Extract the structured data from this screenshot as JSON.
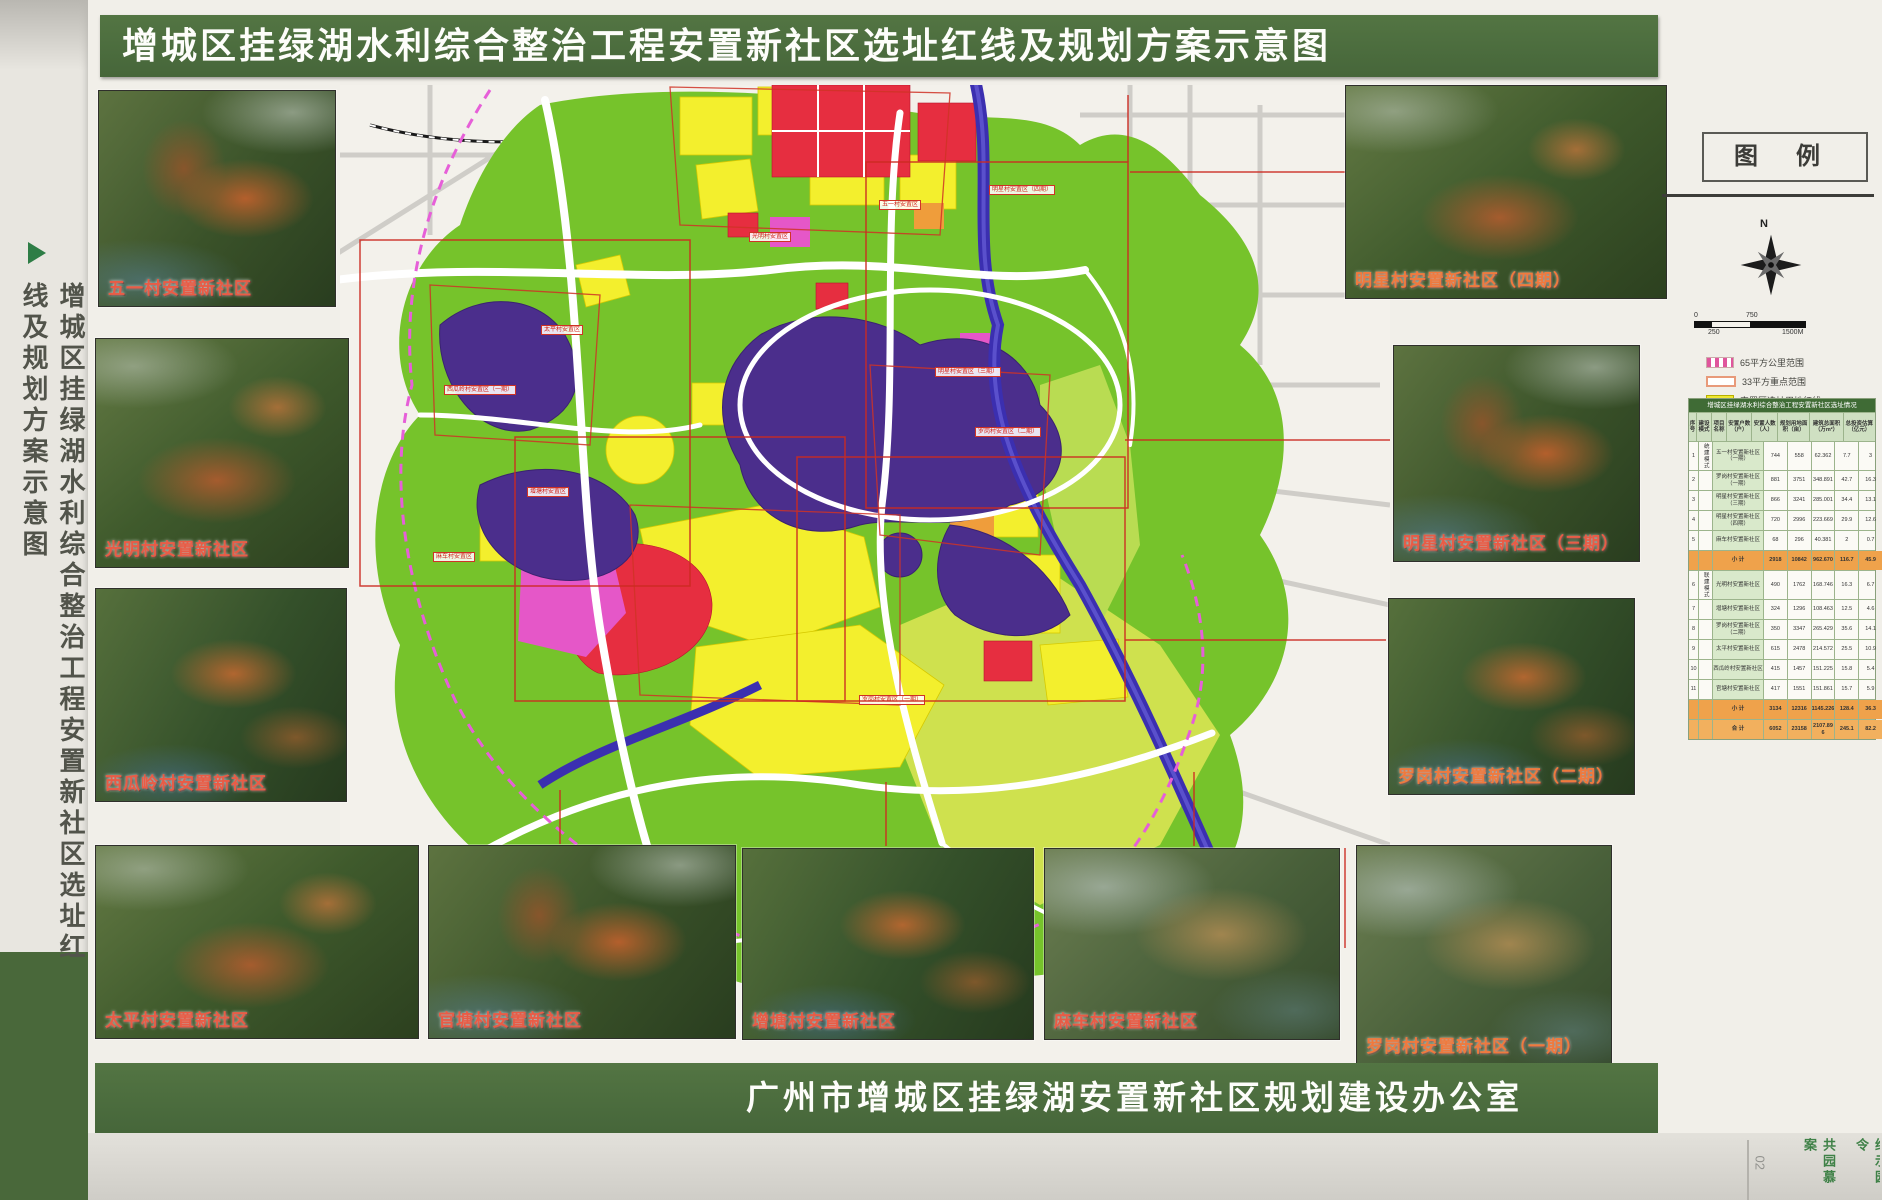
{
  "title_banner": "增城区挂绿湖水利综合整治工程安置新社区选址红线及规划方案示意图",
  "side_title": "增城区挂绿湖水利综合整治工程安置新社区选址红线及规划方案示意图",
  "footer_banner": "广州市增城区挂绿湖安置新社区规划建设办公室",
  "page_number": "02",
  "edge_texts": [
    "共园慕案",
    "给示园令"
  ],
  "photos": {
    "wuyi": {
      "label": "五一村安置新社区"
    },
    "guangming": {
      "label": "光明村安置新社区"
    },
    "xigualing": {
      "label": "西瓜岭村安置新社区"
    },
    "taiping": {
      "label": "太平村安置新社区"
    },
    "guantang": {
      "label": "官塘村安置新社区"
    },
    "zengtang": {
      "label": "增塘村安置新社区"
    },
    "mache": {
      "label": "麻车村安置新社区"
    },
    "luogang1": {
      "label": "罗岗村安置新社区（一期）"
    },
    "mingxing4": {
      "label": "明星村安置新社区（四期）"
    },
    "mingxing3": {
      "label": "明星村安置新社区（三期）"
    },
    "luogang2": {
      "label": "罗岗村安置新社区（二期）"
    }
  },
  "legend": {
    "title": "图 例",
    "compass_label": "N",
    "scale": {
      "t0": "0",
      "t750": "750",
      "t250": "250",
      "t1500": "1500M"
    },
    "items": [
      {
        "label": "65平方公里范围",
        "type": "dashed"
      },
      {
        "label": "33平方重点范围",
        "type": "outline"
      },
      {
        "label": "安置区选址用地红线",
        "type": "yellow"
      },
      {
        "label": "水面",
        "type": "water"
      }
    ],
    "table": {
      "title": "增城区挂绿湖水利综合整治工程安置新社区选址情况",
      "headers": [
        {
          "t": "序号"
        },
        {
          "t": "建设模式"
        },
        {
          "t": "项目名称"
        },
        {
          "t": "安置户数（户）"
        },
        {
          "t": "安置人数（人）"
        },
        {
          "t": "规划用地面积（亩）"
        },
        {
          "t": "建筑总面积（万m²）"
        },
        {
          "t": "总投资估算（亿元）"
        }
      ],
      "rows": [
        {
          "no": "1",
          "mode": "统建模式",
          "name": "五一村安置新社区（一期）",
          "hh": "744",
          "pp": "558",
          "area": "62.362",
          "floor": "7.7",
          "inv": "3",
          "cls": ""
        },
        {
          "no": "2",
          "mode": "",
          "name": "罗岗村安置新社区（一期）",
          "hh": "881",
          "pp": "3751",
          "area": "348.891",
          "floor": "42.7",
          "inv": "16.3",
          "cls": ""
        },
        {
          "no": "3",
          "mode": "",
          "name": "明星村安置新社区（三期）",
          "hh": "866",
          "pp": "3241",
          "area": "285.001",
          "floor": "34.4",
          "inv": "13.1",
          "cls": ""
        },
        {
          "no": "4",
          "mode": "",
          "name": "明星村安置新社区（四期）",
          "hh": "720",
          "pp": "2996",
          "area": "223.669",
          "floor": "29.9",
          "inv": "12.6",
          "cls": ""
        },
        {
          "no": "5",
          "mode": "",
          "name": "麻车村安置新社区",
          "hh": "68",
          "pp": "296",
          "area": "40.381",
          "floor": "2",
          "inv": "0.7",
          "cls": ""
        },
        {
          "no": "",
          "mode": "",
          "name": "小 计",
          "hh": "2918",
          "pp": "10842",
          "area": "962.670",
          "floor": "116.7",
          "inv": "45.9",
          "cls": "sum"
        },
        {
          "no": "6",
          "mode": "联建模式",
          "name": "光明村安置新社区",
          "hh": "490",
          "pp": "1762",
          "area": "168.746",
          "floor": "16.3",
          "inv": "6.7",
          "cls": ""
        },
        {
          "no": "7",
          "mode": "",
          "name": "增塘村安置新社区",
          "hh": "324",
          "pp": "1296",
          "area": "108.463",
          "floor": "12.5",
          "inv": "4.6",
          "cls": ""
        },
        {
          "no": "8",
          "mode": "",
          "name": "罗岗村安置新社区（二期）",
          "hh": "350",
          "pp": "3347",
          "area": "265.429",
          "floor": "35.6",
          "inv": "14.1",
          "cls": ""
        },
        {
          "no": "9",
          "mode": "",
          "name": "太平村安置新社区",
          "hh": "615",
          "pp": "2478",
          "area": "214.572",
          "floor": "25.5",
          "inv": "10.9",
          "cls": ""
        },
        {
          "no": "10",
          "mode": "",
          "name": "西瓜岭村安置新社区",
          "hh": "415",
          "pp": "1457",
          "area": "151.225",
          "floor": "15.8",
          "inv": "5.4",
          "cls": ""
        },
        {
          "no": "11",
          "mode": "",
          "name": "官塘村安置新社区",
          "hh": "417",
          "pp": "1551",
          "area": "151.861",
          "floor": "15.7",
          "inv": "5.9",
          "cls": ""
        },
        {
          "no": "",
          "mode": "",
          "name": "小 计",
          "hh": "3134",
          "pp": "12316",
          "area": "1145.226",
          "floor": "128.4",
          "inv": "36.3",
          "cls": "sum"
        },
        {
          "no": "",
          "mode": "",
          "name": "合 计",
          "hh": "6052",
          "pp": "23158",
          "area": "2107.896",
          "floor": "245.1",
          "inv": "82.2",
          "cls": "total"
        }
      ]
    }
  },
  "map": {
    "colors": {
      "green": "#76c32b",
      "yellow": "#f3ef2d",
      "red": "#e62e40",
      "magenta": "#e557c8",
      "water": "#4b2e8c",
      "river": "#3b2fb0",
      "boundary_dashed": "#e65fd8",
      "redline": "#cf3326"
    },
    "callouts": [
      {
        "label": "五一村安置区",
        "pos": {
          "left": "900px",
          "top": "205px"
        }
      },
      {
        "label": "光明村安置区",
        "pos": {
          "left": "770px",
          "top": "237px"
        }
      },
      {
        "label": "明星村安置区（四期）",
        "pos": {
          "left": "1022px",
          "top": "190px"
        }
      },
      {
        "label": "太平村安置区",
        "pos": {
          "left": "562px",
          "top": "330px"
        }
      },
      {
        "label": "西瓜岭村安置区（一期）",
        "pos": {
          "left": "480px",
          "top": "390px"
        }
      },
      {
        "label": "增塘村安置区",
        "pos": {
          "left": "548px",
          "top": "492px"
        }
      },
      {
        "label": "麻车村安置区",
        "pos": {
          "left": "454px",
          "top": "557px"
        }
      },
      {
        "label": "明星村安置区（三期）",
        "pos": {
          "left": "968px",
          "top": "372px"
        }
      },
      {
        "label": "罗岗村安置区（二期）",
        "pos": {
          "left": "1008px",
          "top": "432px"
        }
      },
      {
        "label": "罗岗村安置区（一期）",
        "pos": {
          "left": "892px",
          "top": "700px"
        }
      }
    ]
  }
}
